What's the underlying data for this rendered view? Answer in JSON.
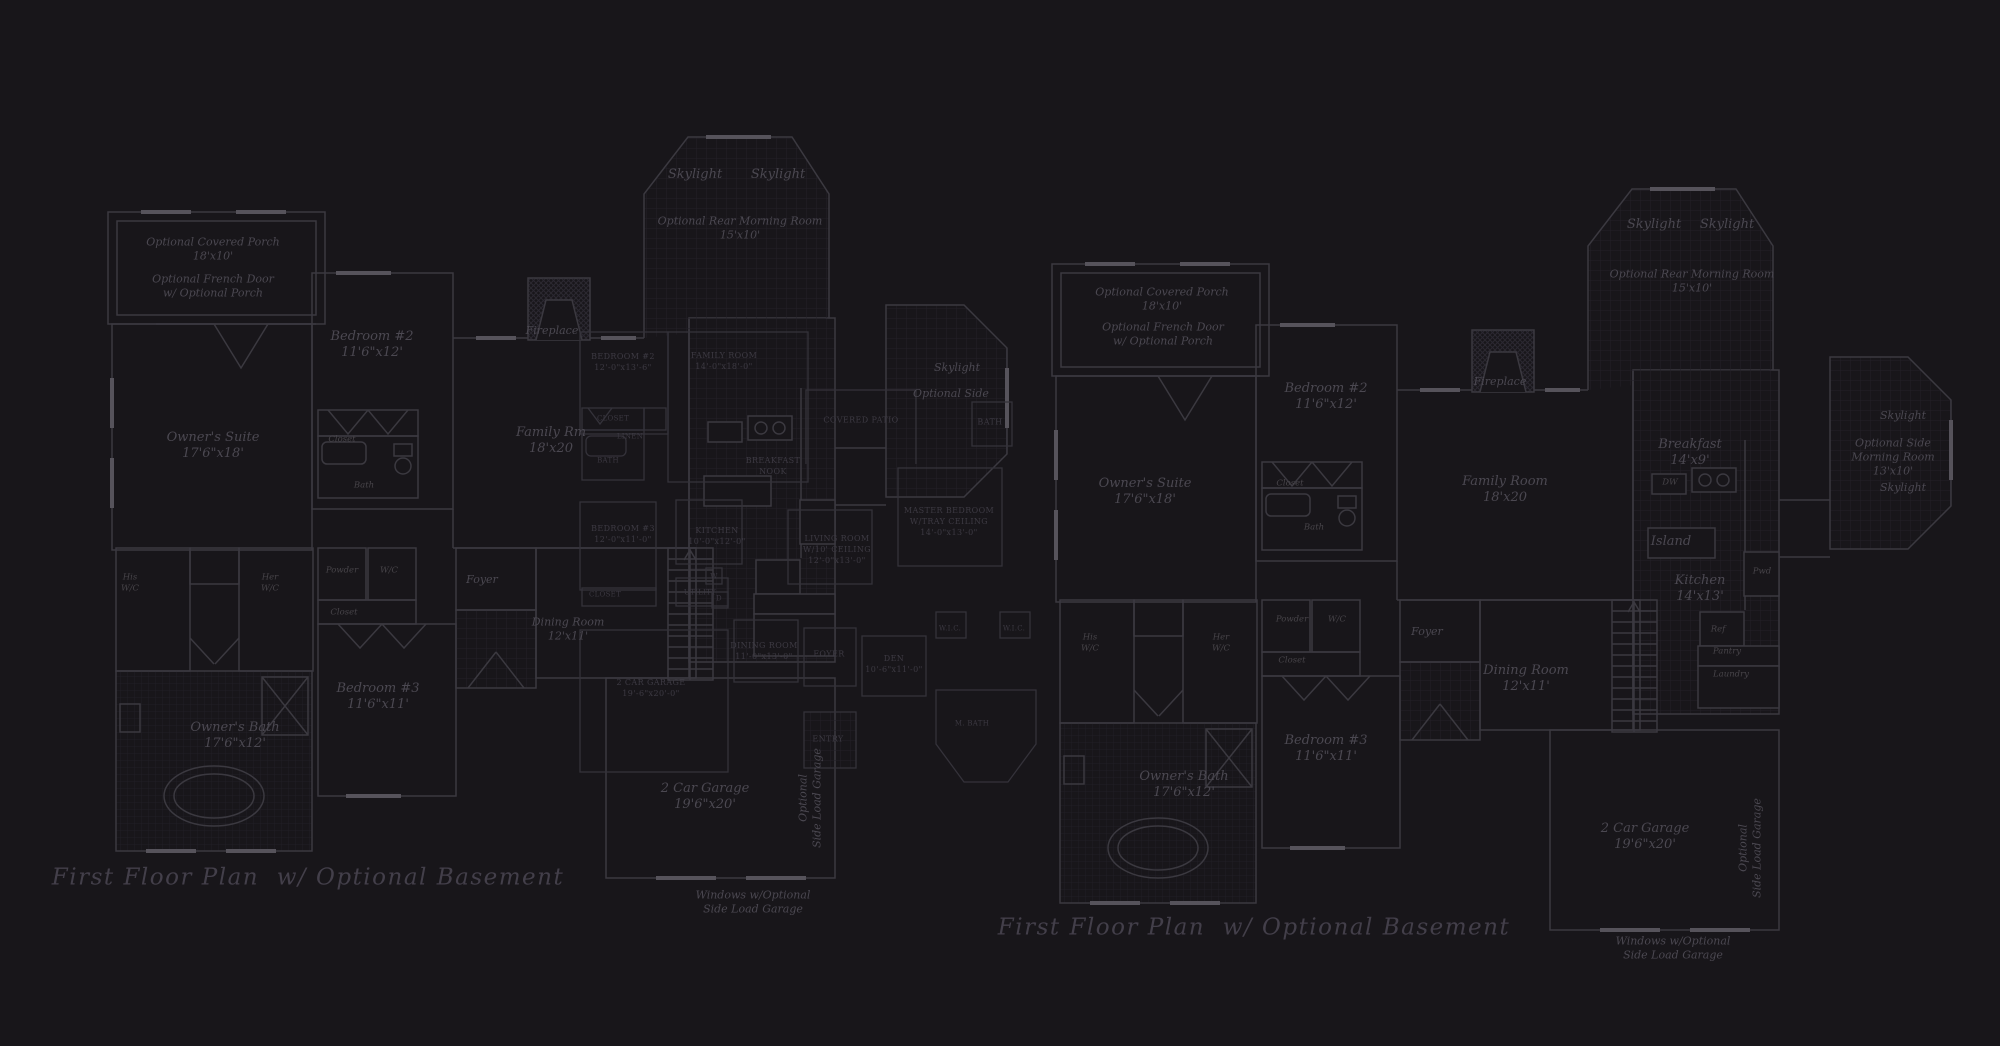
{
  "canvas": {
    "width": 2000,
    "height": 1046,
    "background": "#18161a"
  },
  "palette": {
    "wall_line": "#3b3940",
    "overlay_line": "#34323a",
    "window_fill": "#56535b",
    "tile_grid": "#232028",
    "hatch": "#2b2831",
    "label_text": "#4b4851",
    "caps_text": "#3d3a43",
    "title_text": "#433f4a"
  },
  "sheets": [
    {
      "name": "left-floor-plan",
      "title": "First Floor Plan  w/ Optional Basement"
    },
    {
      "name": "right-floor-plan",
      "title": "First Floor Plan  w/ Optional Basement"
    }
  ],
  "labels": [
    {
      "id": "lt-skylight-a",
      "text": "Skylight"
    },
    {
      "id": "lt-skylight-b",
      "text": "Skylight"
    },
    {
      "id": "lt-morning",
      "text": "Optional Rear Morning Room\n15'x10'"
    },
    {
      "id": "lt-porch",
      "text": "Optional Covered Porch\n18'x10'"
    },
    {
      "id": "lt-french",
      "text": "Optional French Door\nw/ Optional Porch"
    },
    {
      "id": "lt-bed2",
      "text": "Bedroom #2\n11'6\"x12'"
    },
    {
      "id": "lt-fire",
      "text": "Fireplace"
    },
    {
      "id": "lt-suite",
      "text": "Owner's Suite\n17'6\"x18'"
    },
    {
      "id": "lt-famrm",
      "text": "Family Rm\n18'x20"
    },
    {
      "id": "lt-his",
      "text": "His\nW/C"
    },
    {
      "id": "lt-her",
      "text": "Her\nW/C"
    },
    {
      "id": "lt-powder",
      "text": "Powder"
    },
    {
      "id": "lt-wc",
      "text": "W/C"
    },
    {
      "id": "lt-closet2",
      "text": "Closet"
    },
    {
      "id": "lt-closet1",
      "text": "Closet"
    },
    {
      "id": "lt-bath",
      "text": "Bath"
    },
    {
      "id": "lt-foyer",
      "text": "Foyer"
    },
    {
      "id": "lt-dining",
      "text": "Dining Room\n12'x11'"
    },
    {
      "id": "lt-bed3",
      "text": "Bedroom #3\n11'6\"x11'"
    },
    {
      "id": "lt-obath",
      "text": "Owner's Bath\n17'6\"x12'"
    },
    {
      "id": "lt-garage",
      "text": "2 Car Garage\n19'6\"x20'"
    },
    {
      "id": "lt-sideload",
      "text": "Optional\nSide Load Garage"
    },
    {
      "id": "lt-windows",
      "text": "Windows w/Optional\nSide Load Garage"
    },
    {
      "id": "lt-skylight-c",
      "text": "Skylight"
    },
    {
      "id": "lt-optside",
      "text": "Optional Side"
    },
    {
      "id": "lt-title",
      "text": "First Floor Plan  w/ Optional Basement"
    },
    {
      "id": "ov-bed2",
      "text": "BEDROOM #2\n12'-0\"x13'-6\""
    },
    {
      "id": "ov-fam",
      "text": "FAMILY ROOM\n14'-0\"x18'-0\""
    },
    {
      "id": "ov-patio",
      "text": "COVERED PATIO"
    },
    {
      "id": "ov-bath2",
      "text": "BATH"
    },
    {
      "id": "ov-master",
      "text": "MASTER BEDROOM\nW/TRAY CEILING\n14'-0\"x13'-0\""
    },
    {
      "id": "ov-living",
      "text": "LIVING ROOM\nW/10' CEILING\n12'-0\"x13'-0\""
    },
    {
      "id": "ov-nook",
      "text": "BREAKFAST\nNOOK"
    },
    {
      "id": "ov-kitchen",
      "text": "KITCHEN\n10'-0\"x12'-0\""
    },
    {
      "id": "ov-bed3",
      "text": "BEDROOM #3\n12'-0\"x11'-0\""
    },
    {
      "id": "ov-closet",
      "text": "CLOSET"
    },
    {
      "id": "ov-utility",
      "text": "UTILITY"
    },
    {
      "id": "ov-w",
      "text": "W"
    },
    {
      "id": "ov-d",
      "text": "D"
    },
    {
      "id": "ov-dining",
      "text": "DINING ROOM\n11'-0\"x13'-0\""
    },
    {
      "id": "ov-foyer",
      "text": "FOYER"
    },
    {
      "id": "ov-entry",
      "text": "ENTRY"
    },
    {
      "id": "ov-garage",
      "text": "2 CAR GARAGE\n19'-6\"x20'-0\""
    },
    {
      "id": "ov-wic-a",
      "text": "W.I.C."
    },
    {
      "id": "ov-wic-b",
      "text": "W.I.C."
    },
    {
      "id": "ov-mbath",
      "text": "M. BATH"
    },
    {
      "id": "ov-den",
      "text": "DEN\n10'-6\"x11'-0\""
    },
    {
      "id": "ov-closet1",
      "text": "CLOSET"
    },
    {
      "id": "ov-linen",
      "text": "LINEN"
    },
    {
      "id": "ov-bathsm",
      "text": "BATH"
    },
    {
      "id": "rt-skylight-a",
      "text": "Skylight"
    },
    {
      "id": "rt-skylight-b",
      "text": "Skylight"
    },
    {
      "id": "rt-morning",
      "text": "Optional Rear Morning Room\n15'x10'"
    },
    {
      "id": "rt-porch",
      "text": "Optional Covered Porch\n18'x10'"
    },
    {
      "id": "rt-french",
      "text": "Optional French Door\nw/ Optional Porch"
    },
    {
      "id": "rt-bed2",
      "text": "Bedroom #2\n11'6\"x12'"
    },
    {
      "id": "rt-fire",
      "text": "Fireplace"
    },
    {
      "id": "rt-suite",
      "text": "Owner's Suite\n17'6\"x18'"
    },
    {
      "id": "rt-closet1",
      "text": "Closet"
    },
    {
      "id": "rt-bath",
      "text": "Bath"
    },
    {
      "id": "rt-family",
      "text": "Family Room\n18'x20"
    },
    {
      "id": "rt-breakfast",
      "text": "Breakfast\n14'x9'"
    },
    {
      "id": "rt-dw",
      "text": "DW"
    },
    {
      "id": "rt-island",
      "text": "Island"
    },
    {
      "id": "rt-kitchen",
      "text": "Kitchen\n14'x13'"
    },
    {
      "id": "rt-ref",
      "text": "Ref"
    },
    {
      "id": "rt-pantry",
      "text": "Pantry"
    },
    {
      "id": "rt-laundry",
      "text": "Laundry"
    },
    {
      "id": "rt-skylight-c",
      "text": "Skylight"
    },
    {
      "id": "rt-sidemorning",
      "text": "Optional Side\nMorning Room\n13'x10'"
    },
    {
      "id": "rt-skylight-d",
      "text": "Skylight"
    },
    {
      "id": "rt-his",
      "text": "His\nW/C"
    },
    {
      "id": "rt-her",
      "text": "Her\nW/C"
    },
    {
      "id": "rt-powder",
      "text": "Powder"
    },
    {
      "id": "rt-wc",
      "text": "W/C"
    },
    {
      "id": "rt-closet2",
      "text": "Closet"
    },
    {
      "id": "rt-foyer",
      "text": "Foyer"
    },
    {
      "id": "rt-dining",
      "text": "Dining Room\n12'x11'"
    },
    {
      "id": "rt-bed3",
      "text": "Bedroom #3\n11'6\"x11'"
    },
    {
      "id": "rt-obath",
      "text": "Owner's Bath\n17'6\"x12'"
    },
    {
      "id": "rt-garage",
      "text": "2 Car Garage\n19'6\"x20'"
    },
    {
      "id": "rt-sideload",
      "text": "Optional\nSide Load Garage"
    },
    {
      "id": "rt-windows",
      "text": "Windows w/Optional\nSide Load Garage"
    },
    {
      "id": "rt-pwd",
      "text": "Pwd"
    },
    {
      "id": "rt-title",
      "text": "First Floor Plan  w/ Optional Basement"
    }
  ]
}
